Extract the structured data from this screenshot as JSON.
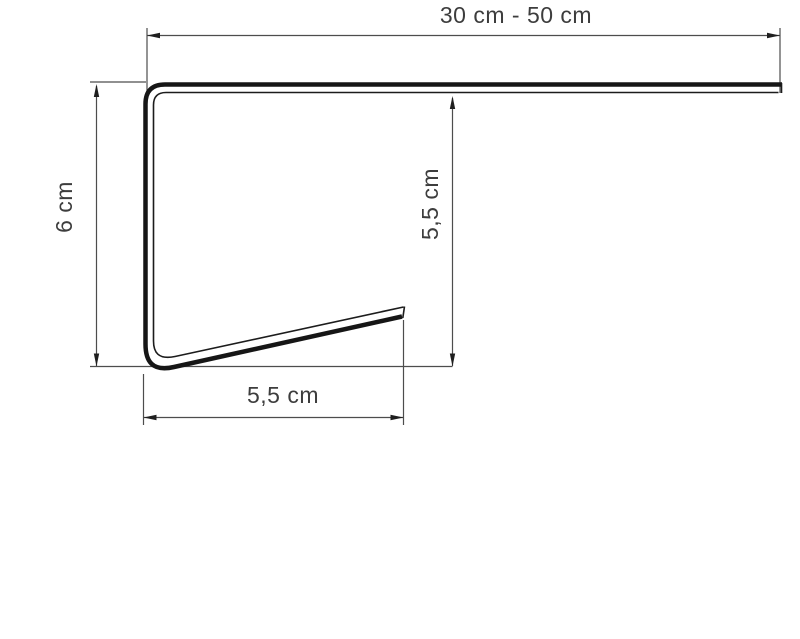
{
  "diagram": {
    "type": "technical-profile-drawing",
    "labels": {
      "top_width": "30 cm - 50 cm",
      "left_height": "6 cm",
      "inner_height": "5,5 cm",
      "bottom_depth": "5,5 cm"
    },
    "colors": {
      "background": "#ffffff",
      "profile_line": "#161616",
      "dimension_line": "#4d4d4d",
      "text": "#3d3d3d"
    }
  }
}
